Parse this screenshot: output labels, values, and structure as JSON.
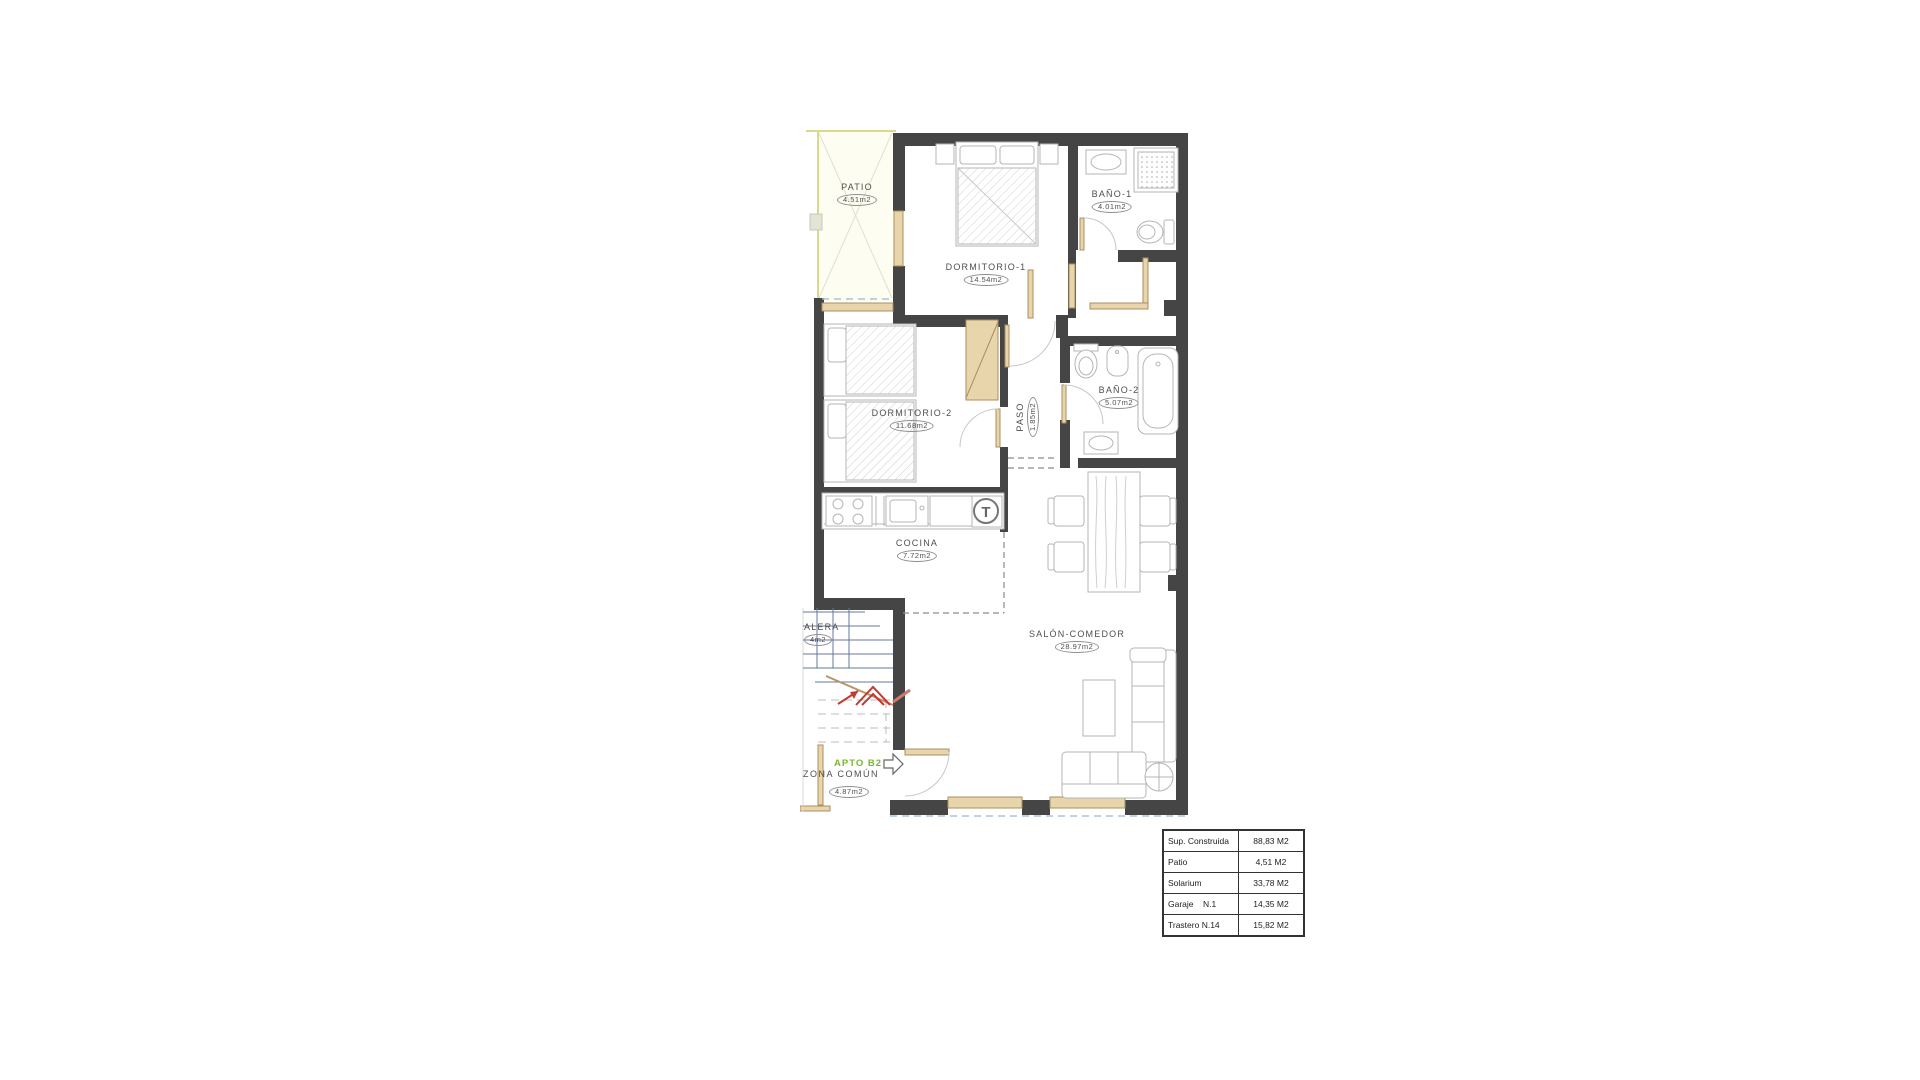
{
  "plan": {
    "apartment_tag": {
      "label": "APTO B2",
      "color": "#76b82a"
    },
    "rooms": {
      "patio": {
        "name": "PATIO",
        "area": "4.51m2"
      },
      "dormitorio1": {
        "name": "DORMITORIO-1",
        "area": "14.54m2"
      },
      "bano1": {
        "name": "BAÑO-1",
        "area": "4.01m2"
      },
      "dormitorio2": {
        "name": "DORMITORIO-2",
        "area": "11.68m2"
      },
      "bano2": {
        "name": "BAÑO-2",
        "area": "5.07m2"
      },
      "paso": {
        "name": "PASO",
        "area": "1.85m2"
      },
      "cocina": {
        "name": "COCINA",
        "area": "7.72m2"
      },
      "salon": {
        "name": "SALÓN-COMEDOR",
        "area": "28.97m2"
      },
      "escalera": {
        "name": "ALERA",
        "area": "4m2"
      },
      "zona_comun": {
        "name": "ZONA COMÚN",
        "area": "4.87m2"
      }
    },
    "fixtures": {
      "water_heater": "T"
    }
  },
  "summary_table": {
    "rows": [
      {
        "label": "Sup. Construida",
        "value": "88,83 M2"
      },
      {
        "label": "Patio",
        "value": "4,51 M2"
      },
      {
        "label": "Solarium",
        "value": "33,78 M2"
      },
      {
        "label": "Garaje    N.1",
        "value": "14,35 M2"
      },
      {
        "label": "Trastero N.14",
        "value": "15,82 M2"
      }
    ]
  },
  "colors": {
    "wall": "#454545",
    "carpentry_wood": "#e8d5ac",
    "furniture_line": "#b5b5b5",
    "patio_line": "#d9d98e",
    "glass_dashed": "#a9c4da",
    "stairs_line": "#67779d",
    "arrow_red": "#c23a31",
    "label_text": "#4f4f4f",
    "apto_green": "#76b82a"
  }
}
